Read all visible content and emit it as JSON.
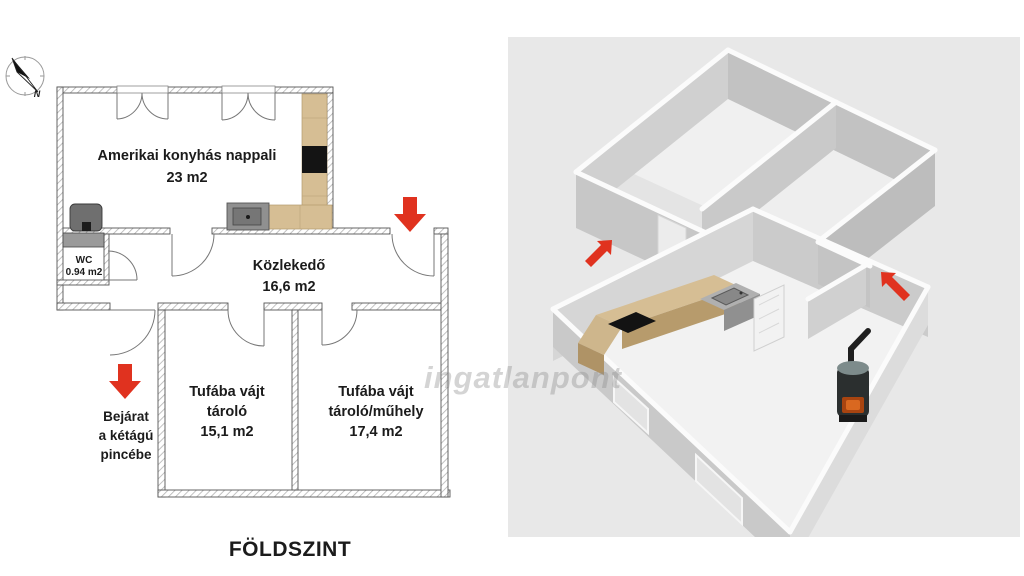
{
  "plan": {
    "title": "FÖLDSZINT",
    "compass_letter": "N",
    "rooms": {
      "living": {
        "name": "Amerikai konyhás nappali",
        "area": "23 m2"
      },
      "hallway": {
        "name": "Közlekedő",
        "area": "16,6 m2"
      },
      "wc": {
        "name": "WC",
        "area": "0.94 m2"
      },
      "storage1": {
        "line1": "Tufába vájt",
        "line2": "tároló",
        "area": "15,1 m2"
      },
      "storage2": {
        "line1": "Tufába vájt",
        "line2": "tároló/műhely",
        "area": "17,4 m2"
      }
    },
    "cellar_note": {
      "line1": "Bejárat",
      "line2": "a kétágú",
      "line3": "pincébe"
    }
  },
  "view3d": {
    "watermark": "ingatlanpont"
  },
  "colors": {
    "arrow_red": "#e0321f",
    "counter_tan": "#d6be94",
    "counter_tan_dark": "#b79b6c",
    "wall_gray": "#c9c9c9",
    "panel_bg": "#e8e8e8"
  }
}
